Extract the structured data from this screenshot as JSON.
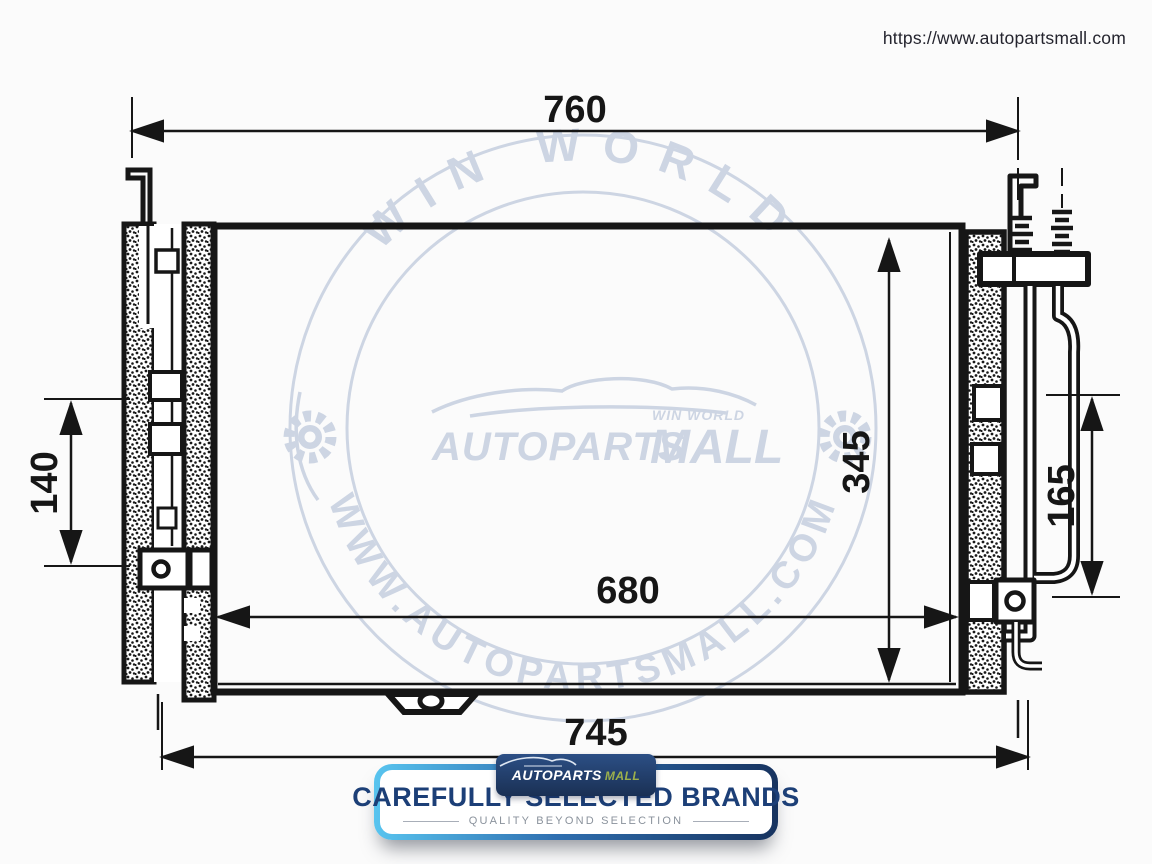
{
  "page": {
    "url": "https://www.autopartsmall.com",
    "background": "#fbfbfb",
    "ink": "#161616"
  },
  "diagram": {
    "part": "ac-condenser-technical-drawing",
    "dims": {
      "top_width": "760",
      "left_bracket_height": "140",
      "core_height": "345",
      "right_span": "165",
      "core_width": "680",
      "overall_width": "745"
    }
  },
  "watermark": {
    "color": "#cdd5e3",
    "arc_top": "WIN WORLD",
    "arc_bottom": "WWW.AUTOPARTSMALL.COM",
    "brand_main": "AUTOPARTS",
    "brand_suffix": "MALL",
    "brand_tag": "WIN WORLD"
  },
  "banner": {
    "badge": {
      "brand_a": "AUTOPARTS",
      "brand_b": "MALL"
    },
    "title": "CAREFULLY SELECTED BRANDS",
    "subtitle": "QUALITY BEYOND SELECTION",
    "accent_from": "#58c4ef",
    "accent_to": "#17335f",
    "title_color": "#1c3f77"
  }
}
